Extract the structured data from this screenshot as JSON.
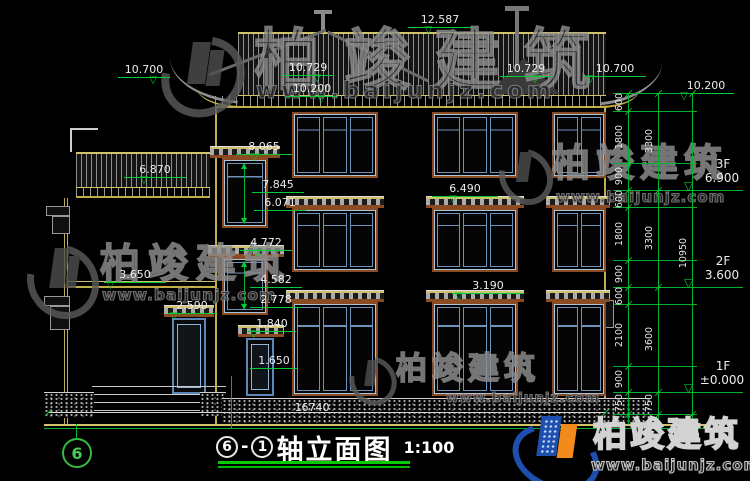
{
  "brand": {
    "name": "柏竣建筑",
    "url": "www.baijunjz.com"
  },
  "title": {
    "axis_left": "6",
    "dash": "-",
    "axis_right": "1",
    "text": "轴立面图",
    "scale": "1:100"
  },
  "axis_bubble": {
    "label": "6"
  },
  "levels": {
    "ridge": "12.587",
    "eave_left_outer": "10.700",
    "eave_left_inner": "10.729",
    "eave_left_low": "10.200",
    "eave_right_inner": "10.729",
    "eave_right_outer": "10.700",
    "eave_right_low": "10.200",
    "stair3_top": "8.065",
    "stair3_head": "7.845",
    "stair3_sill": "6.071",
    "stair2_top": "4.772",
    "stair2_head": "4.582",
    "stair2_sill": "2.778",
    "left_roof": "6.870",
    "left_floor": "3.650",
    "porch_head": "2.590",
    "ledge_3f": "6.490",
    "ledge_1f": "3.190",
    "door_head": "1.840",
    "door_sill": "1.650"
  },
  "floors": [
    {
      "name": "3F",
      "level": "6.900"
    },
    {
      "name": "2F",
      "level": "3.600"
    },
    {
      "name": "1F",
      "level": "±0.000"
    }
  ],
  "dims": {
    "total_width": "16740",
    "total_height": "10950",
    "inner": [
      "600",
      "1800",
      "900",
      "600",
      "1800",
      "900",
      "600",
      "2100",
      "900",
      "750"
    ],
    "middle": [
      "3300",
      "3300",
      "3600",
      "750"
    ]
  },
  "colors": {
    "dimension_green": "#00cc33",
    "wall_yellow": "#bfae4a",
    "window_blue": "#6d93bd",
    "frame_brown": "#8a4a22",
    "logo_blue": "#1e4fae",
    "logo_orange": "#f28a1c",
    "underline_green": "#00cc00"
  }
}
